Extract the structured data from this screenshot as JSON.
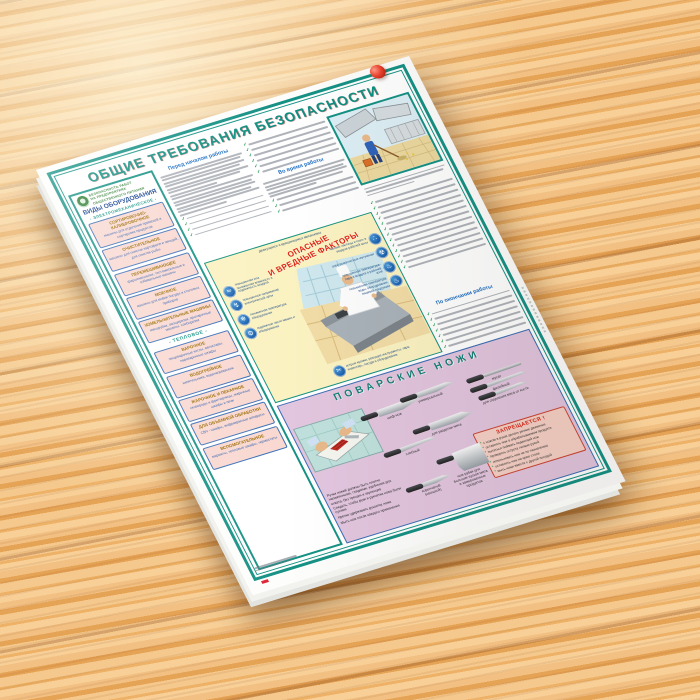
{
  "poster": {
    "title": "ОБЩИЕ ТРЕБОВАНИЯ БЕЗОПАСНОСТИ",
    "accent_colors": {
      "teal": "#159184",
      "red": "#e02416",
      "blue_heading": "#1f6fc4",
      "pink_box": "#f9d8d1",
      "yellow_panel": "#fbf2c2",
      "lavender_panel": "#e2c5de"
    },
    "brand": {
      "line1": "БЕЗОПАСНОСТЬ РАБОТ",
      "line2": "НА ПРЕДПРИЯТИЯХ",
      "line3": "ОБЩЕСТВЕННОГО ПИТАНИЯ"
    },
    "sections": {
      "before": "Перед началом работы",
      "during": "Во время работы",
      "after": "По окончании работы"
    },
    "sidebar": {
      "title": "ВИДЫ ОБОРУДОВАНИЯ",
      "subtitle": "- ЭЛЕКТРОМЕХАНИЧЕСКОЕ -",
      "divider": "- ТЕПЛОВОЕ -",
      "items_top": [
        {
          "label": "СОРТИРОВОЧНО-КАЛИБРОВОЧНОЕ",
          "desc": "машины для отделения примесей и сортировки продуктов"
        },
        {
          "label": "ОЧИСТИТЕЛЬНОЕ",
          "desc": "машины для очистки картофеля и овощей, для очистки рыбы"
        },
        {
          "label": "ПЕРЕМЕШИВАЮЩЕЕ",
          "desc": "фаршемешалки, тестомесильные и взбивальные машины"
        },
        {
          "label": "МОЕЧНОЕ",
          "desc": "машины для мойки посуды и столовых приборов"
        },
        {
          "label": "ИЗМЕЛЬЧИТЕЛЬНЫЕ МАШИНЫ",
          "desc": "мясорубки, овощерезки, протирочные машины, хлеборезки"
        }
      ],
      "items_thermal": [
        {
          "label": "ВАРОЧНОЕ",
          "desc": "пищеварочные котлы, автоклавы, пароварочные шкафы"
        },
        {
          "label": "ВОДОГРЕЙНОЕ",
          "desc": "кипятильники, водонагреватели"
        },
        {
          "label": "ЖАРОЧНОЕ И ПЕКАРНОЕ",
          "desc": "сковороды и фритюрницы, жарочные шкафы и печи"
        },
        {
          "label": "ДЛЯ ОБЪЕМНОЙ ОБРАБОТКИ",
          "desc": "СВЧ - шкафы, инфракрасные аппараты"
        },
        {
          "label": "ВСПОМОГАТЕЛЬНОЕ",
          "desc": "мармиты, тепловые шкафы, термостаты"
        }
      ]
    },
    "factors": {
      "title_line1": "ОПАСНЫЕ",
      "title_line2": "И ВРЕДНЫЕ ФАКТОРЫ",
      "top_caption": "движущиеся и вращающиеся механизмы",
      "left": [
        {
          "icon": "humidity-icon",
          "glyph": "≈",
          "label": "повышенная или пониженная влажность и подвижность воздуха"
        },
        {
          "icon": "voltage-icon",
          "glyph": "↯",
          "label": "повышенное напряжение электрической цепи"
        },
        {
          "icon": "cold-icon",
          "glyph": "❄",
          "label": "пониженная температура оборудования"
        },
        {
          "icon": "gears-icon",
          "glyph": "⚙",
          "label": "подвижные части машин и оборудования"
        }
      ],
      "right": [
        {
          "icon": "particles-icon",
          "glyph": "∴",
          "label": "мелкие частицы и пыль в воздухе рабочей зоны"
        },
        {
          "icon": "radiation-icon",
          "glyph": "☢",
          "label": "электромагнитные излучения"
        },
        {
          "icon": "steam-icon",
          "glyph": "♨",
          "label": "повышенная температура пара и воздуха в рабочей зоне"
        },
        {
          "icon": "hot-surface-icon",
          "glyph": "♨",
          "label": "повышенная температура воды, оборудования, пищевой продукции"
        }
      ],
      "bottom": {
        "icon": "sharp-edges-icon",
        "glyph": "✂",
        "label": "острые кромки, режущие инструменты, тара, инвентарь, посуда и оборудование"
      }
    },
    "knives": {
      "title": "ПОВАРСКИЕ  НОЖИ",
      "col_a": [
        {
          "type": "chef",
          "label": "шеф-нож"
        },
        {
          "type": "bread",
          "label": "хлебный"
        },
        {
          "type": "paring",
          "label": "коренчатый (овощной)"
        }
      ],
      "col_b": [
        {
          "type": "utility",
          "label": "универсальный"
        },
        {
          "type": "butcher",
          "label": "для разделки мяса"
        },
        {
          "type": "cleaver",
          "label": "нож-рубак для больших кусков мяса и замороженных продуктов"
        }
      ],
      "col_c": [
        {
          "type": "steel",
          "label": "мусат"
        },
        {
          "type": "fillet",
          "label": "филейный"
        },
        {
          "type": "boning",
          "label": "для отделения мяса от кости"
        }
      ],
      "tips": [
        "Ручки ножей должны быть плотно насаженными, гладкими, удобными для охвата, без трещин и заусенцев",
        "Следить, чтобы руки и рукоятка ножа были сухими",
        "Крепко удерживать рукоятку ножа",
        "Мыть нож после каждого применения"
      ],
      "forbidden": {
        "title": "ЗАПРЕЩАЕТСЯ !",
        "items": [
          "с ножом в руках делать резкие движения",
          "оставлять нож в обрабатываемом продукте",
          "пытаться поймать падающий нож",
          "проверять остроту лезвия рукой",
          "использовать нож не по назначению",
          "оставлять нож на краю стола",
          "мыть ножи вместе с другой посудой"
        ]
      }
    }
  }
}
